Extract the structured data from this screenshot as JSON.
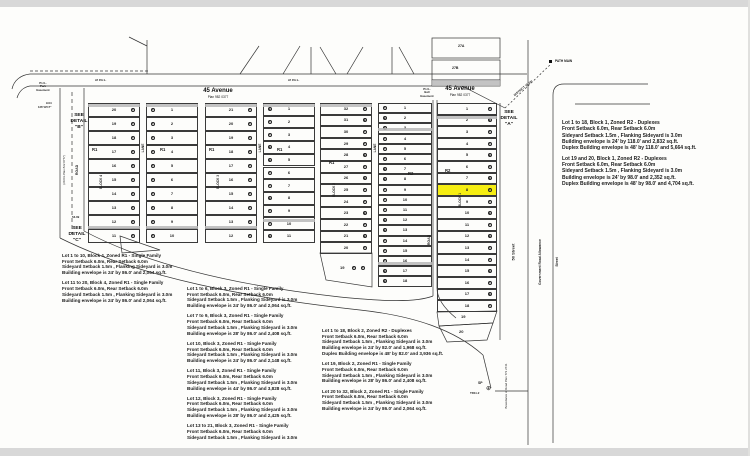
{
  "colors": {
    "paper": "#fdfdfb",
    "margin": "#d8d8d8",
    "ink": "#333333",
    "highlight": "#f6ee12"
  },
  "streets": {
    "avenue_name": "45 Avenue",
    "avenue_plan": "Plan 982 0377",
    "avenue_name_2": "45 Avenue",
    "avenue_plan_2": "Plan 982 0377",
    "road_left": "ROAD",
    "road_left_plan": "(20.0m Plan 822 0777)",
    "road_right": "ROAD",
    "street_50": "50 Street",
    "gov_allowance": "Government Road Allowance",
    "street_far": "Street",
    "boundary_note": "Boundaries of Road Plan 772 2741",
    "lane": "LANE",
    "pul_left": "10 P.U.L.",
    "pul_right": "10 P.U.L."
  },
  "details": {
    "a": "SEE\nDETAIL\n\"A\"",
    "b": "SEE\nDETAIL\n\"B\"",
    "c": "SEE\nDETAIL\n\"C\""
  },
  "markers": {
    "path_main": "PATH MAIN",
    "district_line": "DISTRICT 15.2m",
    "sp": "SP",
    "sp_id": "TR11.2",
    "easement_left": "P.U.L.\nPark\nEasement",
    "easement_right": "P.U.L.\nBell\nEasement",
    "dim_904": "9.04",
    "dim_angle": "126°19'17\"",
    "dim_5309": "53.09",
    "parcel_27a": "27A",
    "parcel_27b": "27B"
  },
  "plat": {
    "blocks": [
      {
        "label": "BLOCK 4",
        "zone": "R1",
        "left_lots": [
          "20",
          "19",
          "18",
          "17",
          "16",
          "15",
          "14",
          "13",
          "12",
          "11"
        ],
        "right_lots": [
          "1",
          "2",
          "3",
          "4",
          "5",
          "6",
          "7",
          "8",
          "9",
          "10"
        ]
      },
      {
        "label": "BLOCK 3",
        "zone": "R1",
        "left_lots": [
          "21",
          "20",
          "19",
          "18",
          "17",
          "16",
          "15",
          "14",
          "13",
          "12"
        ],
        "right_lots": [
          "1",
          "2",
          "3",
          "4",
          "5",
          "6",
          "7",
          "8",
          "9",
          "10",
          "11"
        ]
      },
      {
        "label": "BLOCK 2",
        "zone_left": "R1",
        "zone_right": "R2",
        "left_lots": [
          "32",
          "31",
          "30",
          "29",
          "28",
          "27",
          "26",
          "25",
          "24",
          "23",
          "22",
          "21",
          "20"
        ],
        "right_lots": [
          "1",
          "2",
          "3",
          "4",
          "5",
          "6",
          "7",
          "8",
          "9",
          "10",
          "11",
          "12",
          "13",
          "14",
          "15",
          "16",
          "17",
          "18"
        ],
        "angled_lot": "19"
      },
      {
        "label": "BLOCK 1",
        "zone": "R2",
        "lots": [
          "1",
          "2",
          "3",
          "4",
          "5",
          "6",
          "7",
          "8",
          "9",
          "10",
          "11",
          "12",
          "13",
          "14",
          "15",
          "16",
          "17",
          "18"
        ],
        "angled_lots": [
          "19",
          "20"
        ],
        "highlighted_lot": "8"
      }
    ]
  },
  "notes": {
    "block1": {
      "paragraphs": [
        [
          "Lot 1 to 18, Block 1, Zoned R2 - Duplexes",
          "Front Setback 6.0m, Rear Setback 6.0m",
          "Sideyard Setback 1.5m , Flanking Sideyard is 3.0m",
          "Building envelope is 24' by 118.0' and 2,832 sq.ft.",
          "Duplex Building envelope is 48' by 118.0' and 5,664 sq.ft."
        ],
        [
          "Lot 19 and 20, Block 1, Zoned R2 - Duplexes",
          "Front Setback 6.0m, Rear Setback 6.0m",
          "Sideyard Setback 1.5m , Flanking Sideyard is 3.0m",
          "Building envelope is 24' by 98.0' and 2,352 sq.ft.",
          "Duplex Building envelope is 48' by 98.0' and 4,704 sq.ft."
        ]
      ]
    },
    "block4": {
      "paragraphs": [
        [
          "Lot 1 to 10, Block 4, Zoned R1 - Single Family",
          "Front Setback 6.0m, Rear Setback 6.0m",
          "Sideyard Setback 1.5m , Flanking Sideyard is 3.0m",
          "Building envelope is 24' by 86.0' and 2,064 sq.ft."
        ],
        [
          "Lot 11 to 20, Block 4, Zoned R1 - Single Family",
          "Front Setback 6.0m, Rear Setback 6.0m",
          "Sideyard Setback 1.5m , Flanking Sideyard is 3.0m",
          "Building envelope is 24' by 86.0' and 2,064 sq.ft."
        ]
      ]
    },
    "block3": {
      "paragraphs": [
        [
          "Lot 1 to 6, Block 3, Zoned R1 - Single Family",
          "Front Setback 6.0m, Rear Setback 6.0m",
          "Sideyard Setback 1.5m , Flanking Sideyard is 3.0m",
          "Building envelope is 24' by 86.0' and 2,064 sq.ft."
        ],
        [
          "Lot 7 to 9, Block 3, Zoned R1 - Single Family",
          "Front Setback 6.0m, Rear Setback 6.0m",
          "Sideyard Setback 1.5m , Flanking Sideyard is 3.0m",
          "Building envelope is 28' by 86.0' and 2,408 sq.ft."
        ],
        [
          "Lot 10, Block 3, Zoned R1 - Single Family",
          "Front Setback 6.0m, Rear Setback 6.0m",
          "Sideyard Setback 1.5m , Flanking Sideyard is 3.0m",
          "Building envelope is 24' by 86.0' and 2,148 sq.ft."
        ],
        [
          "Lot 11, Block 3, Zoned R1 - Single Family",
          "Front Setback 6.0m, Rear Setback 6.0m",
          "Sideyard Setback 1.5m , Flanking Sideyard is 3.0m",
          "Building envelope is 44' by 86.0' and 3,828 sq.ft."
        ],
        [
          "Lot 12, Block 3, Zoned R1 - Single Family",
          "Front Setback 6.0m, Rear Setback 6.0m",
          "Sideyard Setback 1.5m , Flanking Sideyard is 3.0m",
          "Building envelope is 28' by 86.0' and 2,425 sq.ft."
        ],
        [
          "Lot 13 to 21, Block 3, Zoned R1 - Single Family",
          "Front Setback 6.0m, Rear Setback 6.0m",
          "Sideyard Setback 1.5m , Flanking Sideyard is 3.0m"
        ]
      ]
    },
    "block2": {
      "paragraphs": [
        [
          "Lot 1 to 18, Block 2, Zoned R2 - Duplexes",
          "Front Setback 6.0m, Rear Setback 6.0m",
          "Sideyard Setback 1.5m , Flanking Sideyard is 3.0m",
          "Building envelope is 24' by 82.0' and 1,968 sq.ft.",
          "Duplex Building envelope is 48' by 82.0' and 3,936 sq.ft."
        ],
        [
          "Lot 19, Block 2, Zoned R1 - Single Family",
          "Front Setback 6.0m, Rear Setback 6.0m",
          "Sideyard Setback 1.5m , Flanking Sideyard is 3.0m",
          "Building envelope is 28' by 86.0' and 2,408 sq.ft."
        ],
        [
          "Lot 20 to 32, Block 2, Zoned R1 - Single Family",
          "Front Setback 6.0m, Rear Setback 6.0m",
          "Sideyard Setback 1.5m , Flanking Sideyard is 3.0m",
          "Building envelope is 24' by 86.0' and 2,064 sq.ft."
        ]
      ]
    }
  }
}
